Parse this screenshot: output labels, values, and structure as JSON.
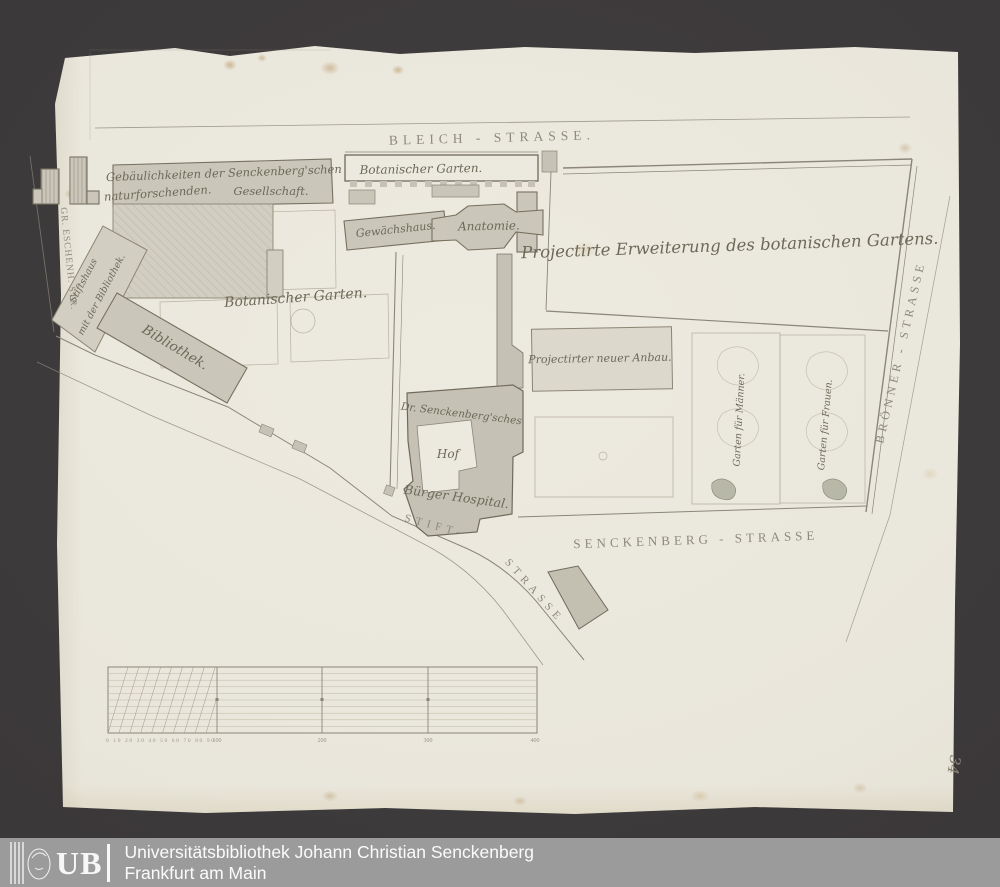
{
  "colors": {
    "background": "#3c393a",
    "paper": "#e9e6db",
    "footer_bar": "#9b9b9b",
    "ink": "#6d6959",
    "street_ink": "#8d897c"
  },
  "map": {
    "streets": {
      "bleich": "BLEICH - STRASSE.",
      "gr_eschenheimer": "GR. ESCHENH. STR.",
      "stift_upper": "STIFT-",
      "stift_lower": "STRASSE",
      "senckenberg": "SENCKENBERG - STRASSE",
      "broenner": "BRÖNNER - STRASSE"
    },
    "labels": {
      "garden_house_top": "Botanischer Garten.",
      "gesellschaft_line1": "Gebäulichkeiten der Senckenberg'schen",
      "gesellschaft_line2": "naturforschenden.",
      "gesellschaft_line3": "Gesellschaft.",
      "stiftshaus_line1": "Stiftshaus",
      "stiftshaus_line2": "mit der Bibliothek.",
      "bibliothek": "Bibliothek.",
      "botanischer_garten": "Botanischer Garten.",
      "gewaechshaus": "Gewächshaus.",
      "anatomie": "Anatomie.",
      "erweiterung": "Projectirte Erweiterung des botanischen Gartens.",
      "neuer_anbau": "Projectirter neuer Anbau.",
      "senckenbergsches": "Dr. Senckenberg'sches",
      "hof": "Hof",
      "buerger_hospital": "Bürger Hospital.",
      "garten_maenner": "Garten für Männer.",
      "garten_frauen": "Garten für Frauen."
    },
    "scale": {
      "minor": "0 10 20 30 40 50 60 70 80 90",
      "majors": [
        "100",
        "200",
        "300",
        "400"
      ]
    },
    "handwritten_number": "34"
  },
  "footer": {
    "logo_text": "UB",
    "line1": "Universitätsbibliothek Johann Christian Senckenberg",
    "line2": "Frankfurt am Main"
  }
}
